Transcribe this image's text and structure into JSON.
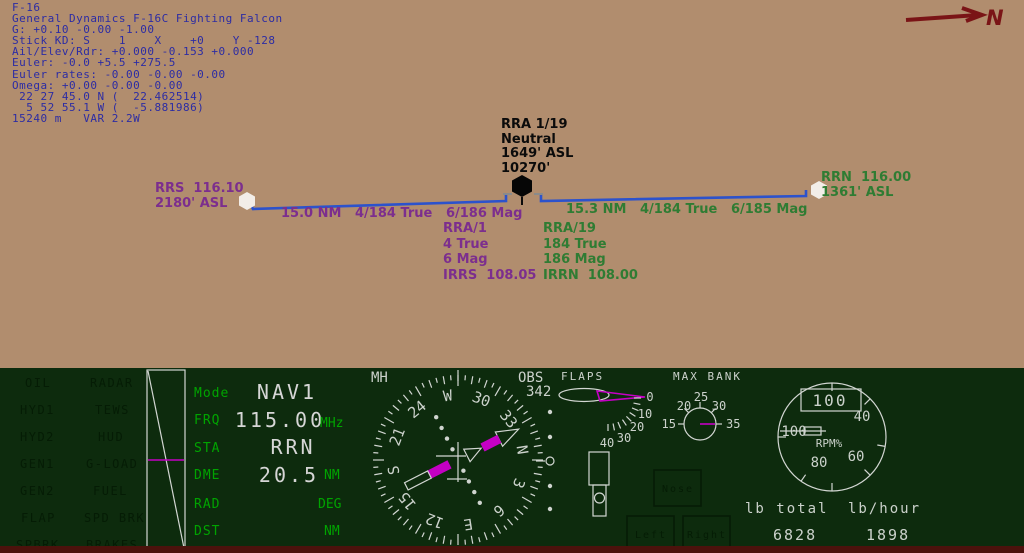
{
  "colors": {
    "map_bg": "#b18d6e",
    "map_blue": "#2c2ca4",
    "purple": "#7c2e8e",
    "green": "#2f7c33",
    "route_blue": "#2c52cc",
    "ink": "#0b0b0b",
    "north_red": "#7a1416",
    "panel_bg": "#0d2b0d",
    "panel_green": "#00a400",
    "panel_light": "#ccd2cc",
    "magenta": "#c400c4",
    "warn_text": "#051c05",
    "maroon": "#4c120c"
  },
  "map": {
    "telemetry_lines": [
      "F-16",
      "General Dynamics F-16C Fighting Falcon",
      "G: +0.10 -0.00 -1.00",
      "Stick KD: S    1    X    +0    Y -128",
      "Ail/Elev/Rdr: +0.000 -0.153 +0.000",
      "Euler: -0.0 +5.5 +275.5",
      "Euler rates: -0.00 -0.00 -0.00",
      "Omega: +0.00 -0.00 -0.00",
      " 22 27 45.0 N (  22.462514)",
      "  5 52 55.1 W (  -5.881986)",
      "15240 m   VAR 2.2W"
    ],
    "north_label": "N",
    "stations": {
      "left": [
        "RRS  116.10",
        "2180' ASL"
      ],
      "center": [
        "RRA 1/19",
        "Neutral",
        "1649' ASL",
        "10270'"
      ],
      "right": [
        "RRN  116.00",
        "1361' ASL"
      ]
    },
    "legs": {
      "left": "15.0 NM   4/184 True   6/186 Mag",
      "right": "15.3 NM   4/184 True   6/185 Mag"
    },
    "approach_left": [
      "RRA/1",
      "4 True",
      "6 Mag",
      "IRRS  108.05"
    ],
    "approach_right": [
      "RRA/19",
      "184 True",
      "186 Mag",
      "IRRN  108.00"
    ]
  },
  "panel": {
    "warnings_col1": [
      "OIL",
      "HYD1",
      "HYD2",
      "GEN1",
      "GEN2",
      "FLAP",
      "SPBRK"
    ],
    "warnings_col2": [
      "RADAR",
      "TEWS",
      "HUD",
      "G-LOAD",
      "FUEL",
      "SPD BRK",
      "BRAKES"
    ],
    "nav": {
      "rows": [
        {
          "label": "Mode",
          "value": "NAV1",
          "unit": ""
        },
        {
          "label": "FRQ",
          "value": "115.00",
          "unit": "MHz"
        },
        {
          "label": "STA",
          "value": "RRN",
          "unit": ""
        },
        {
          "label": "DME",
          "value": "20.5",
          "unit": "NM"
        },
        {
          "label": "RAD",
          "value": "",
          "unit": "DEG"
        },
        {
          "label": "DST",
          "value": "",
          "unit": "NM"
        }
      ]
    },
    "hsi": {
      "heading_label": "MH",
      "obs_label": "OBS",
      "obs_value": "342",
      "card": [
        "N",
        "3",
        "6",
        "E",
        "12",
        "15",
        "S",
        "21",
        "24",
        "W",
        "30",
        "33"
      ]
    },
    "flaps": {
      "label": "FLAPS",
      "scale": [
        "0",
        "10",
        "20",
        "30",
        "40"
      ]
    },
    "max_bank": {
      "label": "MAX BANK",
      "scale": [
        "15",
        "20",
        "25",
        "30",
        "35"
      ]
    },
    "rpm": {
      "digital": "100",
      "scale": [
        "40",
        "60",
        "80",
        "100"
      ],
      "unit_label": "RPM%"
    },
    "gear": {
      "nose": "Nose",
      "left": "Left",
      "right": "Right"
    },
    "fuel": {
      "total_label": "lb total",
      "flow_label": "lb/hour",
      "total_value": "6828",
      "flow_value": "1898"
    }
  }
}
